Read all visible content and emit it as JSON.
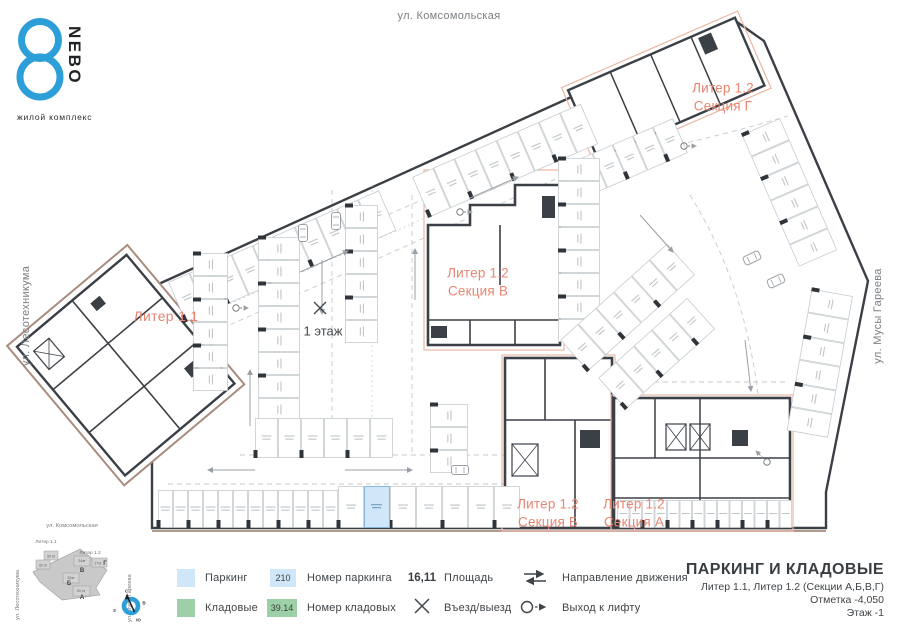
{
  "logo": {
    "number": "8",
    "name": "NEBO",
    "subtitle": "жилой комплекс"
  },
  "streets": {
    "top": "ул. Комсомольская",
    "left": "ул. Лесотехникума",
    "right": "ул. Мусы Гареева"
  },
  "plan": {
    "labels": {
      "liter_1_1": "Литер 1.1",
      "section_v": {
        "line1": "Литер 1.2",
        "line2": "Секция В"
      },
      "section_g": {
        "line1": "Литер 1.2",
        "line2": "Секция Г"
      },
      "section_b": {
        "line1": "Литер 1.2",
        "line2": "Секция Б"
      },
      "section_a": {
        "line1": "Литер 1.2",
        "line2": "Секция А"
      },
      "floor_1": "1 этаж"
    }
  },
  "minimap": {
    "street_top": "ул. Комсомольская",
    "street_left": "ул. Лесотехникума",
    "street_right": "ул. Мусы Гареева",
    "liter11": "Литер 1.1",
    "liter12": "Литер 1.2",
    "sections": [
      {
        "floors": "30 эт",
        "letter": ""
      },
      {
        "floors": "32 эт",
        "letter": ""
      },
      {
        "floors": "24эт",
        "letter": "В"
      },
      {
        "floors": "17эт",
        "letter": "Г"
      },
      {
        "floors": "20эт",
        "letter": "Б"
      },
      {
        "floors": "20 эт",
        "letter": "А"
      }
    ],
    "compass": {
      "n": "С",
      "e": "В",
      "s": "Ю",
      "w": "З"
    }
  },
  "legend": {
    "parking_label": "Паркинг",
    "storage_label": "Кладовые",
    "parking_number_example": "210",
    "parking_number_label": "Номер паркинга",
    "storage_number_example": "39.14",
    "storage_number_label": "Номер кладовых",
    "area_example": "16,11",
    "area_label": "Площадь",
    "entry_label": "Въезд/выезд",
    "direction_label": "Направление движения",
    "lift_label": "Выход к лифту"
  },
  "title_block": {
    "title": "ПАРКИНГ И КЛАДОВЫЕ",
    "subtitle": "Литер 1.1, Литер 1.2 (Секции А,Б,В,Г)",
    "elevation": "Отметка  -4,050",
    "floor": "Этаж  -1"
  },
  "colors": {
    "accent_blue": "#2d9fd8",
    "section_label_salmon": "#e98570",
    "building_outline_tan": "#a98c7d",
    "section_boundary_salmon": "#eab7a3",
    "parking_fill_blue": "#cfe7f8",
    "storage_fill_green": "#9ed0a7",
    "walls_dark": "#3b4046"
  }
}
